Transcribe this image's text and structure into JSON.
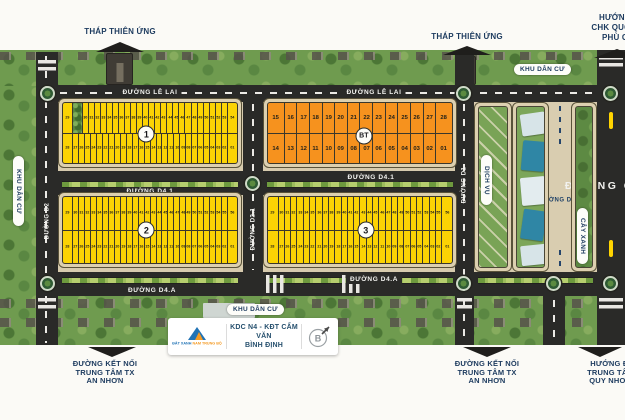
{
  "header": {
    "tower_label_left": "THÁP THIÊN ỨNG",
    "tower_label_right": "THÁP THIÊN ỨNG",
    "airport_direction_lines": [
      "HƯỚNG ĐI",
      "CHK QUỐC TẾ",
      "PHÙ CÁT"
    ]
  },
  "roads": {
    "le_lai_label_1": "ĐƯỜNG LÊ LAI",
    "le_lai_label_2": "ĐƯỜNG LÊ LAI",
    "d41_label_1": "ĐƯỜNG D4.1",
    "d41_label_2": "ĐƯỜNG D4.1",
    "d4a_label_1": "ĐƯỜNG D4.A",
    "d4a_label_2": "ĐƯỜNG D4.A",
    "d2_label": "ĐƯỜNG D2",
    "d21_label": "ĐƯỜNG D2.1",
    "d1_label": "ĐƯỜNG D1",
    "d11_label": "ĐƯỜNG D1.1",
    "ql1_label": "ĐƯỜNG QL.1"
  },
  "area_labels": {
    "khu_dan_cu_left": "KHU DÂN CƯ",
    "khu_dan_cu_top_right": "KHU DÂN CƯ",
    "khu_dan_cu_bottom": "KHU DÂN CƯ",
    "cay_xanh": "CÂY XANH",
    "dich_vu": "DỊCH VỤ"
  },
  "blocks": [
    {
      "label": "1",
      "color": "yellow",
      "top_row": [
        "29",
        "TREE",
        "30",
        "31",
        "32",
        "33",
        "34",
        "35",
        "36",
        "37",
        "38",
        "39",
        "40",
        "41",
        "42",
        "43",
        "44",
        "45",
        "46",
        "47",
        "48",
        "49",
        "50",
        "51",
        "52",
        "53",
        "54"
      ],
      "bottom_row": [
        "28",
        "27",
        "26",
        "25",
        "24",
        "23",
        "22",
        "21",
        "20",
        "19",
        "18",
        "17",
        "16",
        "15",
        "14",
        "13",
        "12",
        "11",
        "10",
        "09",
        "08",
        "07",
        "06",
        "05",
        "04",
        "03",
        "02",
        "01"
      ]
    },
    {
      "label": "BT",
      "color": "orange",
      "top_row": [
        "15",
        "16",
        "17",
        "18",
        "19",
        "20",
        "21",
        "22",
        "23",
        "24",
        "25",
        "26",
        "27",
        "28"
      ],
      "bottom_row": [
        "14",
        "13",
        "12",
        "11",
        "10",
        "09",
        "08",
        "07",
        "06",
        "05",
        "04",
        "03",
        "02",
        "01"
      ]
    },
    {
      "label": "2",
      "color": "yellow",
      "top_row": [
        "29",
        "30",
        "31",
        "32",
        "33",
        "34",
        "35",
        "36",
        "37",
        "38",
        "39",
        "40",
        "41",
        "42",
        "43",
        "44",
        "45",
        "46",
        "47",
        "48",
        "49",
        "50",
        "51",
        "52",
        "53",
        "54",
        "55",
        "56"
      ],
      "bottom_row": [
        "28",
        "27",
        "26",
        "25",
        "24",
        "23",
        "22",
        "21",
        "20",
        "19",
        "18",
        "17",
        "16",
        "15",
        "14",
        "13",
        "12",
        "11",
        "10",
        "09",
        "08",
        "07",
        "06",
        "05",
        "04",
        "03",
        "02",
        "01"
      ]
    },
    {
      "label": "3",
      "color": "yellow",
      "top_row": [
        "29",
        "30",
        "31",
        "32",
        "33",
        "34",
        "35",
        "36",
        "37",
        "38",
        "39",
        "40",
        "41",
        "42",
        "43",
        "44",
        "45",
        "46",
        "47",
        "48",
        "49",
        "50",
        "51",
        "52",
        "53",
        "54",
        "55",
        "56"
      ],
      "bottom_row": [
        "28",
        "27",
        "26",
        "25",
        "24",
        "23",
        "22",
        "21",
        "20",
        "19",
        "18",
        "17",
        "16",
        "15",
        "14",
        "13",
        "12",
        "11",
        "10",
        "09",
        "08",
        "07",
        "06",
        "05",
        "04",
        "03",
        "02",
        "01"
      ]
    }
  ],
  "footer": {
    "connector_left_lines": [
      "ĐƯỜNG KẾT NỐI",
      "TRUNG TÂM TX",
      "AN NHƠN"
    ],
    "connector_right_lines": [
      "ĐƯỜNG KẾT NỐI",
      "TRUNG TÂM TX",
      "AN NHƠN"
    ],
    "quy_nhon_lines": [
      "HƯỚNG ĐI",
      "TRUNG TÂM",
      "QUY NHƠN"
    ],
    "card": {
      "developer_name_part1": "ĐẤT XANH",
      "developer_name_part2": "NAM TRUNG BỘ",
      "project_line1": "KDC N4 - KĐT CẨM VĂN",
      "project_line2": "BÌNH ĐỊNH",
      "compass_letter": "B"
    }
  },
  "colors": {
    "lot_yellow": "#fbd304",
    "lot_orange": "#f6921e",
    "road_black": "#2a2a28",
    "sidewalk_tan": "#d7cbae",
    "navy_text": "#1c3a5e",
    "green_area": "#6f9b4f"
  }
}
